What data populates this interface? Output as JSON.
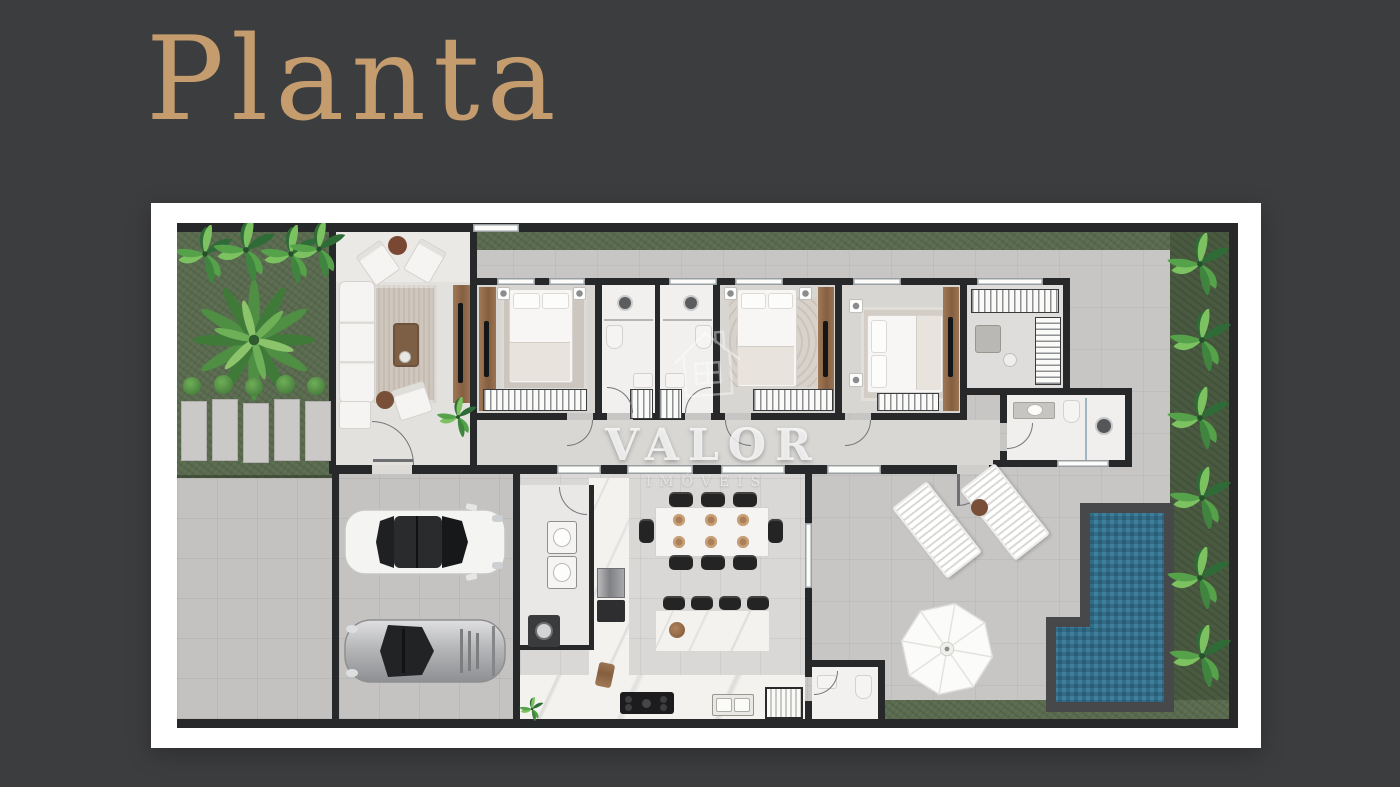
{
  "page": {
    "title": "Planta"
  },
  "watermark": {
    "line1": "VALOR",
    "line2": "IMÓVEIS"
  },
  "palette": {
    "background": "#3c3d3f",
    "title_gold": "#c49c6e",
    "frame_white": "#ffffff",
    "paving": "#c7c6c4",
    "interior_floor": "#e0dfdc",
    "wall": "#27282a",
    "grass": "#5a6b4f",
    "plant_bed": "#4a5a41",
    "pool_water": "#346d88",
    "pool_rim": "#474849",
    "wood": "#96714f",
    "marble": "#f3f2ef",
    "black_furniture": "#242425"
  },
  "icons": [
    "palm-tree-icon",
    "monstera-plant-icon",
    "white-car-icon",
    "silver-car-icon",
    "umbrella-icon",
    "shower-head-icon",
    "washing-machine-icon",
    "house-watermark-icon"
  ]
}
